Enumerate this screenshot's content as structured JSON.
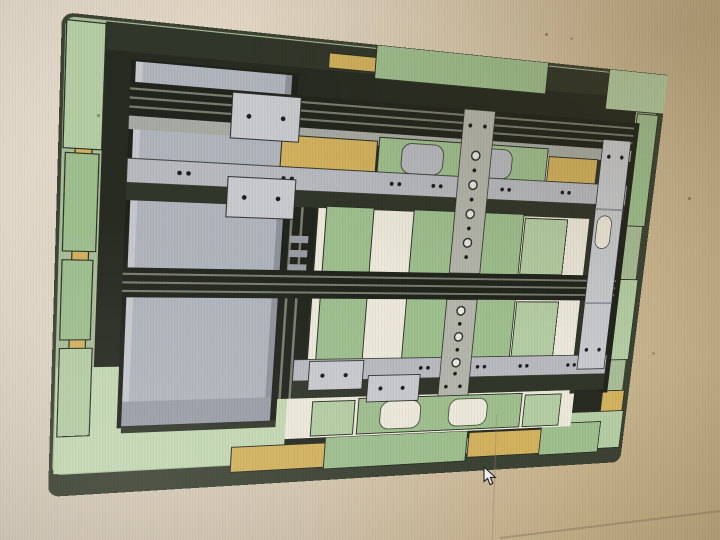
{
  "scene": {
    "description": "Photograph of a computer monitor displaying a 3D CAD model, viewed from the top and photographed at a slight angle, of a rectangular pallet fixture frame assembly. No text or UI chrome is visible.",
    "cursor": {
      "type": "arrow",
      "x": 483,
      "y": 466
    }
  },
  "colors": {
    "bg-left": "#e6dccd",
    "bg-mid": "#ddcfb9",
    "bg-right": "#d5c098",
    "bg-corner": "#cab588",
    "base-side": "#3d4334",
    "base-top": "#a9bd97",
    "platform": "#c3d7b1",
    "interior": "#272b22",
    "shadow": "#31362a",
    "edge": "#2b3026",
    "block-green": "#9fbf8f",
    "block-green-light": "#b5cda4",
    "block-yellow": "#d2b25e",
    "rail-dark": "#22251d",
    "rail-line": "#787d70",
    "subrail": "#a8aba4",
    "gray-rail": "#b8bac0",
    "column": "#b1b4bc",
    "column-hi": "#c6c8ce",
    "column-edge": "#8f929b",
    "column-end": "#9a9da6",
    "col-shadow": "#1f231c",
    "strip": "#b4b6ac",
    "plate": "#c8cace",
    "panel-cream": "#ece8da",
    "hole": "#1c1c1c",
    "cursor-fill": "#ededed"
  },
  "model": {
    "name": "pallet-fixture-assembly",
    "view": "top view, rotated slightly clockwise with keystone perspective",
    "components": {
      "base": "rectangular base plate, rounded corners, dark olive side faces, sage-green top border, bright green exposed platform at bottom-left",
      "perimeter_green_blocks": 13,
      "perimeter_yellow_blocks": 7,
      "left_column": "wide light-gray beam spanning vertically on the left with visible end cap at bottom",
      "horizontal_rails": [
        "top dark double rail",
        "middle dark double rail",
        "upper gray hole-rail",
        "lower gray hole-rail"
      ],
      "vertical_rails": [
        "dark rail right of column",
        "dark rail at right side"
      ],
      "center_strip": {
        "description": "vertical gray strip with alternating large rings and small holes",
        "large_holes": 7,
        "small_holes": 8,
        "end_hole_pairs": 2
      },
      "hole_plates": {
        "count": 5,
        "holes_each": 2,
        "note": "one tall plate on right side with rounded slot"
      },
      "interior_bays": "cream open deck areas between rails",
      "interior_green_blocks": 11,
      "rail_hole_pairs": 12
    }
  }
}
